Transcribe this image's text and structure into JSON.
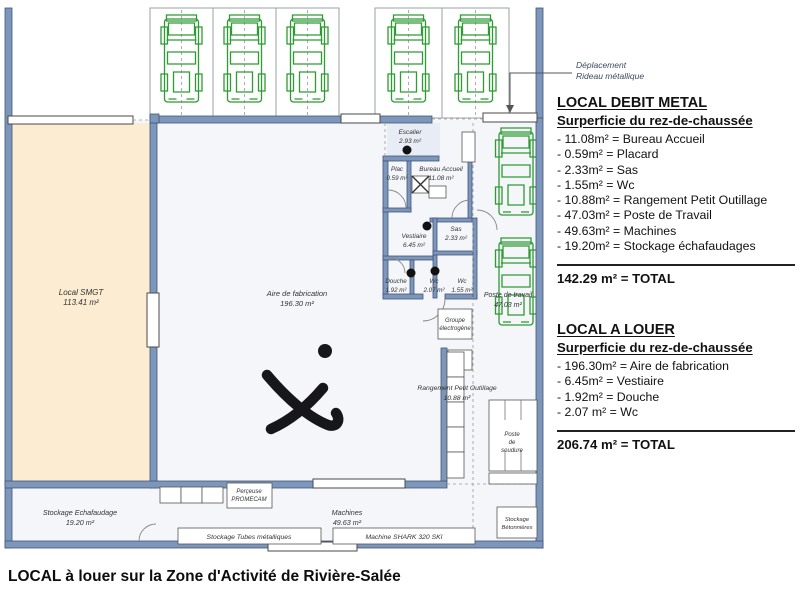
{
  "title": "LOCAL à louer sur la Zone d'Activité de Rivière-Salée",
  "annotation": {
    "line1": "Déplacement",
    "line2": "Rideau métallique"
  },
  "panel1": {
    "heading": "LOCAL DEBIT METAL",
    "subheading": "Surperficie du rez-de-chaussée",
    "items": [
      "- 11.08m² = Bureau Accueil",
      "- 0.59m² = Placard",
      "- 2.33m² = Sas",
      "- 1.55m² = Wc",
      "- 10.88m² = Rangement Petit Outillage",
      "- 47.03m² = Poste de Travail",
      "- 49.63m² = Machines",
      "- 19.20m² = Stockage échafaudages"
    ],
    "total": "142.29 m² = TOTAL"
  },
  "panel2": {
    "heading": "LOCAL A LOUER",
    "subheading": "Surperficie du rez-de-chaussée",
    "items": [
      "- 196.30m² = Aire de fabrication",
      "- 6.45m² = Vestiaire",
      "- 1.92m² = Douche",
      "- 2.07 m² = Wc"
    ],
    "total": "206.74 m² = TOTAL"
  },
  "plan": {
    "colors": {
      "wall": "#7d97bb",
      "wallBorder": "#41567a",
      "beige": "#fcecd2",
      "floor": "#f4f6fa",
      "escalierFloor": "#e8ecf4",
      "green": "#2e9b33",
      "ink": "#17171b"
    },
    "labels": {
      "smgt_name": "Local SMGT",
      "smgt_area": "113.41 m²",
      "aire_name": "Aire de fabrication",
      "aire_area": "196.30 m²",
      "escalier_name": "Escalier",
      "escalier_area": "2.93 m²",
      "plac_name": "Plac",
      "plac_area": "0.59 m²",
      "bureau_name": "Bureau Accueil",
      "bureau_area": "11.08 m²",
      "sas_name": "Sas",
      "sas_area": "2.33 m²",
      "vestiaire_name": "Vestiaire",
      "vestiaire_area": "6.45 m²",
      "douche_name": "Douche",
      "douche_area": "1.92 m²",
      "wc1_name": "Wc",
      "wc1_area": "2.07 m²",
      "wc2_name": "Wc",
      "wc2_area": "1.55 m²",
      "poste_travail_name": "Poste de travail",
      "poste_travail_area": "47.03 m²",
      "groupe_l1": "Groupe",
      "groupe_l2": "électrogène",
      "rangement_name": "Rangement Petit Outillage",
      "rangement_area": "10.88 m²",
      "stockage_echaf_name": "Stockage Echafaudage",
      "stockage_echaf_area": "19.20 m²",
      "machines_name": "Machines",
      "machines_area": "49.63 m²",
      "soudure_l1": "Poste",
      "soudure_l2": "de",
      "soudure_l3": "soudure",
      "betonnieres_l1": "Stockage",
      "betonnieres_l2": "Bétonnières",
      "perceuse_l1": "Perçeuse",
      "perceuse_l2": "PROMECAM",
      "tubes_name": "Stockage Tubes métalliques",
      "shark_name": "Machine SHARK 320 SKI"
    }
  }
}
